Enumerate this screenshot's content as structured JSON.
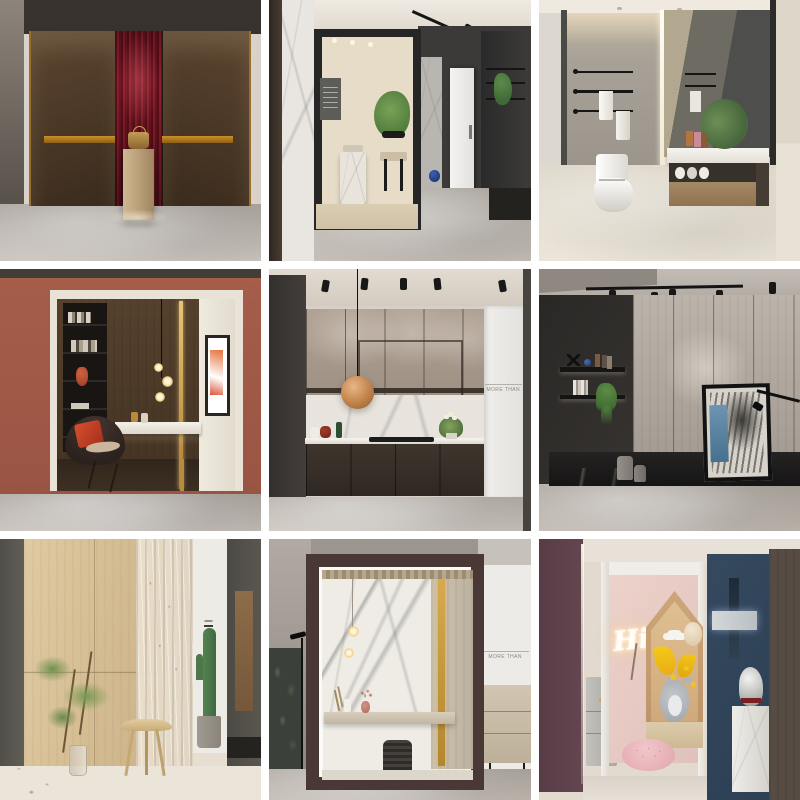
{
  "gallery": {
    "kind": "interior-design showroom photo grid",
    "rows": 3,
    "cols": 3,
    "gap_px": 8,
    "background": "#ffffff"
  },
  "tiles": [
    {
      "id": "entry-red-niche",
      "title": "Entry wall with burgundy fluted niche",
      "description": "Dark bronze leather wall panels with brass inlay bands flank a spotlit burgundy fluted niche; a travertine pedestal displays a brass bag; grey marble floor.",
      "colors": {
        "upper_wall": "#37322e",
        "panel": "#4b3826",
        "niche": "#6d141f",
        "brass": "#b07a1e",
        "pedestal": "#c6b28d",
        "floor": "#bdb7b1"
      }
    },
    {
      "id": "showroom-corridor",
      "title": "Showroom corridor with framed tea-room vignette",
      "description": "Black box frame opens onto a cream tea room with marble pedestal table, black chair and green plant; dark corridor to the right with track lights, white door, display shelving and a blue sphere on grey marble floor.",
      "colors": {
        "frame": "#262626",
        "room": "#e7dcc8",
        "corridor_wall": "#3b3a38",
        "floor": "#b3aca6"
      }
    },
    {
      "id": "bathroom-vignette",
      "title": "Bathroom with grey stone wall and floating vanity",
      "description": "Grey stone feature wall with three black towel rails and white towels, smart toilet, floating walnut vanity with white marble top, greenery and a large back-lit mirror; beige marble floor.",
      "colors": {
        "stone_wall": "#a39c93",
        "vanity_wood": "#9b7e5e",
        "counter": "#f3f1ec",
        "floor": "#e3ddd2"
      }
    },
    {
      "id": "terracotta-study-niche",
      "title": "Terracotta display box with reading nook",
      "description": "Terracotta surround frames a dark walnut niche holding a black bookcase with red vase, floating white marble desk, brass light strip, glass-globe pendant and a dark armchair with red cushion.",
      "colors": {
        "surround": "#a15b49",
        "interior_wood": "#4d3b2a",
        "desk": "#f0ede6",
        "cushion": "#c23a29",
        "floor": "#bdb6b0"
      }
    },
    {
      "id": "kitchen-display",
      "title": "Kitchen display with copper pendant",
      "wall_text": "MORE THAN",
      "description": "Taupe stone upper cabinets over a white marble splashback and dark oak base units with hob; spherical copper pendant, track spotlights, styling props and a white brand panel at right.",
      "colors": {
        "uppers": "#a99a8d",
        "splashback": "#e7e3dc",
        "base_units": "#38302a",
        "pendant": "#c98e52",
        "floor": "#c8c2bb"
      }
    },
    {
      "id": "dark-display-wall",
      "title": "Dark gallery wall with leaning portrait art",
      "description": "Charcoal wall with two floating shelves of curios and a trailing plant, pale oak slat back wall, black stone plinth with cylinder stools and a large leaning abstract-face artwork lit by a black arm lamp.",
      "colors": {
        "dark_wall": "#2e2c2a",
        "back_wall": "#b6aea6",
        "plinth": "#1c1b1a",
        "art_accent": "#5b88a8",
        "floor": "#b3aca4"
      }
    },
    {
      "id": "japandi-corner",
      "title": "Japandi corner with stool, branch and cactus",
      "description": "Light oak panelled walls with a sheer linen curtain, curved-seat wooden stool, glass vase of green branches, tall cactus in a concrete pot and terrazzo floor.",
      "colors": {
        "oak": "#d9c29a",
        "curtain": "#e6dccb",
        "cactus": "#4f7a52",
        "floor": "#eae3d7"
      }
    },
    {
      "id": "marble-booth",
      "title": "Maroon booth with marble feature wall",
      "wall_text": "MORE THAN",
      "description": "Deep maroon display booth lined in white; calacatta marble back wall with brass strip and oak slats, glowing glass pendants, floating stone console with pink vase, and a woven black stool; brand wall and oak cabinet outside.",
      "colors": {
        "frame": "#4a3836",
        "marble": "#efece6",
        "brass": "#caa144",
        "cabinet": "#cbbfae",
        "floor": "#b5aea7"
      }
    },
    {
      "id": "kids-room-display",
      "title": "Kids room display with neon sign and bust",
      "neon_sign_text": "Hi",
      "description": "Blush pink nook with glowing neon script sign, house-shaped oak niche filled with plush cat, yellow wings, stars and cloud, pink tufted pouf; navy wall with marble cross art and a silver bust on a marble plinth.",
      "colors": {
        "pink_wall": "#e5c9c2",
        "navy_wall": "#31455c",
        "maroon_panel": "#5d3f49",
        "house_wood": "#c79f6e",
        "pouf": "#eab8bc"
      }
    }
  ]
}
